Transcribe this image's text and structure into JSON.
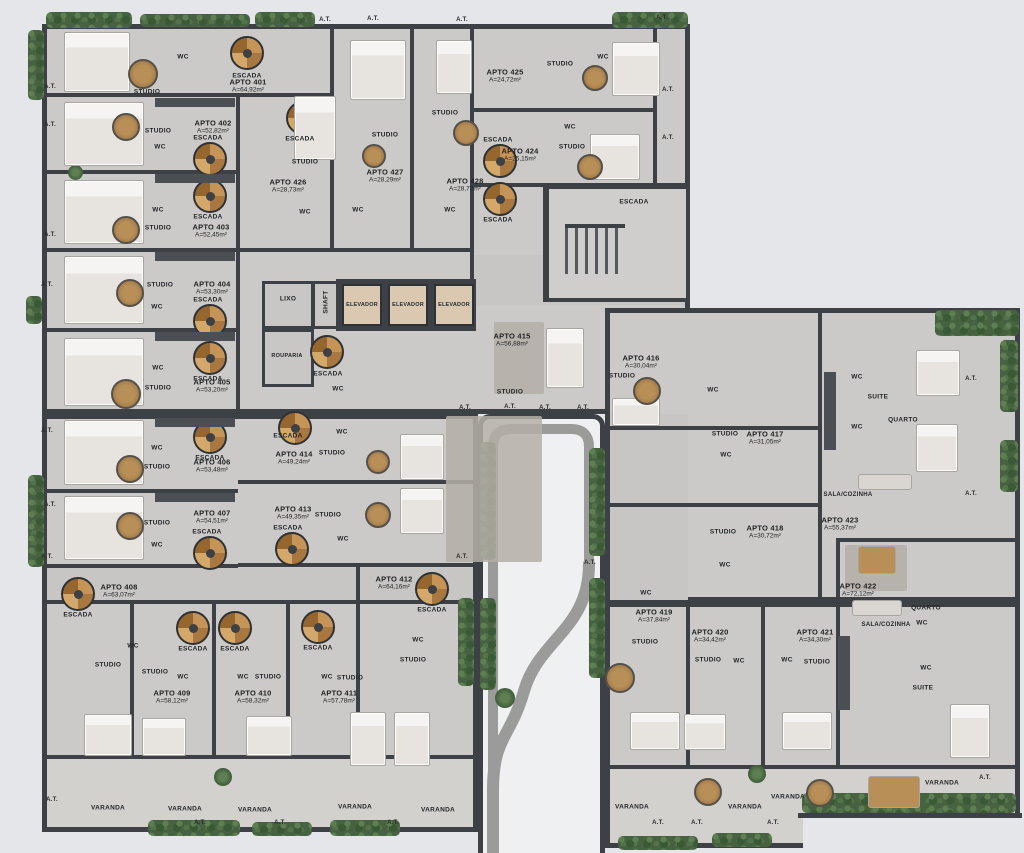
{
  "colors": {
    "background": "#e4e6e9",
    "walls": "#3d4045",
    "floor": "#cbcac8",
    "floor_dark": "#c7c6c4",
    "wood": "#c79457",
    "greenery": "#46613f",
    "void": "#eef0f2",
    "walkway": "#9b9b99",
    "elevator_cab": "#dac9b0"
  },
  "labels": {
    "studio": "STUDIO",
    "wc": "WC",
    "escada": "ESCADA",
    "elevador": "ELEVADOR",
    "varanda": "VARANDA",
    "at": "A.T.",
    "lixo": "LIXO",
    "shaft": "SHAFT",
    "rouparia": "ROUPARIA",
    "suite": "SUITE",
    "quarto": "QUARTO",
    "sala_cozinha": "SALA/COZINHA"
  },
  "apartments": [
    {
      "id": "apto-401",
      "name": "APTO 401",
      "area": "A=64,92m²"
    },
    {
      "id": "apto-402",
      "name": "APTO 402",
      "area": "A=52,82m²"
    },
    {
      "id": "apto-403",
      "name": "APTO 403",
      "area": "A=52,45m²"
    },
    {
      "id": "apto-404",
      "name": "APTO 404",
      "area": "A=53,30m²"
    },
    {
      "id": "apto-405",
      "name": "APTO 405",
      "area": "A=53,20m²"
    },
    {
      "id": "apto-406",
      "name": "APTO 406",
      "area": "A=53,48m²"
    },
    {
      "id": "apto-407",
      "name": "APTO 407",
      "area": "A=54,51m²"
    },
    {
      "id": "apto-408",
      "name": "APTO 408",
      "area": "A=63,07m²"
    },
    {
      "id": "apto-409",
      "name": "APTO 409",
      "area": "A=58,12m²"
    },
    {
      "id": "apto-410",
      "name": "APTO 410",
      "area": "A=58,32m²"
    },
    {
      "id": "apto-411",
      "name": "APTO 411",
      "area": "A=57,78m²"
    },
    {
      "id": "apto-412",
      "name": "APTO 412",
      "area": "A=64,16m²"
    },
    {
      "id": "apto-413",
      "name": "APTO 413",
      "area": "A=49,35m²"
    },
    {
      "id": "apto-414",
      "name": "APTO 414",
      "area": "A=49,24m²"
    },
    {
      "id": "apto-415",
      "name": "APTO 415",
      "area": "A=56,88m²"
    },
    {
      "id": "apto-416",
      "name": "APTO 416",
      "area": "A=30,04m²"
    },
    {
      "id": "apto-417",
      "name": "APTO 417",
      "area": "A=31,05m²"
    },
    {
      "id": "apto-418",
      "name": "APTO 418",
      "area": "A=30,72m²"
    },
    {
      "id": "apto-419",
      "name": "APTO 419",
      "area": "A=37,84m²"
    },
    {
      "id": "apto-420",
      "name": "APTO 420",
      "area": "A=34,42m²"
    },
    {
      "id": "apto-421",
      "name": "APTO 421",
      "area": "A=34,30m²"
    },
    {
      "id": "apto-422",
      "name": "APTO 422",
      "area": "A=72,12m²"
    },
    {
      "id": "apto-423",
      "name": "APTO 423",
      "area": "A=55,37m²"
    },
    {
      "id": "apto-424",
      "name": "APTO 424",
      "area": "A=25,15m²"
    },
    {
      "id": "apto-425",
      "name": "APTO 425",
      "area": "A=24,72m²"
    },
    {
      "id": "apto-426",
      "name": "APTO 426",
      "area": "A=28,73m²"
    },
    {
      "id": "apto-427",
      "name": "APTO 427",
      "area": "A=28,29m²"
    },
    {
      "id": "apto-428",
      "name": "APTO 428",
      "area": "A=28,73m²"
    }
  ]
}
